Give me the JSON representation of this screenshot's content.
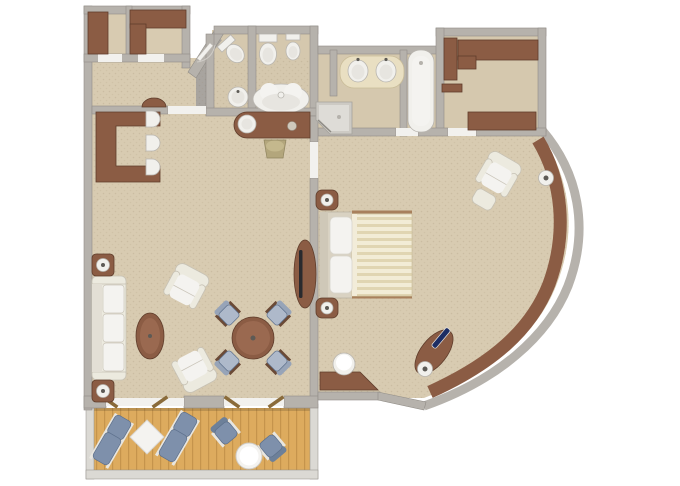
{
  "scene": {
    "type": "floor-plan-3d-top-view",
    "subject": "suite-with-bedroom-living-room-bathrooms-and-balcony",
    "text_labels": []
  },
  "colors": {
    "background": "#ffffff",
    "wall": "#b6b2ac",
    "wallEdge": "#918d87",
    "wallLight": "#dbd9d4",
    "carpet": "#d8cbb1",
    "bathFloor": "#d5c8ae",
    "entryFloor": "#a8a49f",
    "wood": "#8b5c44",
    "woodDark": "#5f3d2b",
    "woodLight": "#9a6950",
    "cream": "#eceadf",
    "creamLine": "#c7c2b5",
    "white": "#f4f3f0",
    "fixture": "#f1f0ec",
    "fixtureEdge": "#b9b6b0",
    "counter": "#e9dfc2",
    "deck": "#ddab5e",
    "deckLine": "#c5944c",
    "blue": "#7e90ab",
    "blueDark": "#5d708c",
    "blueChair": "#aeb9ca",
    "navy": "#1d2d64",
    "olive": "#b3a67c",
    "gold": "#8a6b3a"
  },
  "rooms": [
    {
      "name": "entry-closets",
      "furniture": [
        "wardrobe",
        "l-shaped-wardrobe"
      ]
    },
    {
      "name": "entry-vestibule",
      "furniture": [
        "entry-door"
      ]
    },
    {
      "name": "hallway",
      "furniture": [
        "half-round-console"
      ]
    },
    {
      "name": "wc-room",
      "furniture": [
        "toilet",
        "round-basin"
      ]
    },
    {
      "name": "master-bathroom",
      "furniture": [
        "toilet",
        "bidet",
        "whirlpool-tub",
        "corner-shower",
        "double-sink-vanity",
        "bathtub"
      ]
    },
    {
      "name": "walk-in-closet",
      "furniture": [
        "cabinet",
        "cabinet",
        "shelf",
        "cabinet"
      ]
    },
    {
      "name": "living-room",
      "furniture": [
        "u-shaped-desk",
        "desk-chair",
        "desk-chair",
        "desk-chair",
        "vanity-table-with-mirror",
        "stool",
        "sofa",
        "end-table-with-lamp",
        "end-table-with-lamp",
        "armchair",
        "armchair",
        "oval-coffee-table",
        "round-dining-table",
        "dining-chair",
        "dining-chair",
        "dining-chair",
        "dining-chair",
        "tv-console"
      ]
    },
    {
      "name": "bedroom",
      "furniture": [
        "double-bed",
        "nightstand-with-lamp",
        "nightstand-with-lamp",
        "armchair-with-ottoman",
        "angled-dresser",
        "round-stool",
        "curved-window-ledge",
        "ledge-lamp",
        "ledge-lamp",
        "navy-accent-item"
      ]
    },
    {
      "name": "balcony",
      "furniture": [
        "lounger",
        "lounger",
        "diamond-side-table",
        "deck-chair",
        "deck-chair",
        "round-table",
        "railing",
        "wood-deck",
        "door-leaf",
        "door-leaf",
        "door-leaf",
        "door-leaf"
      ]
    }
  ]
}
